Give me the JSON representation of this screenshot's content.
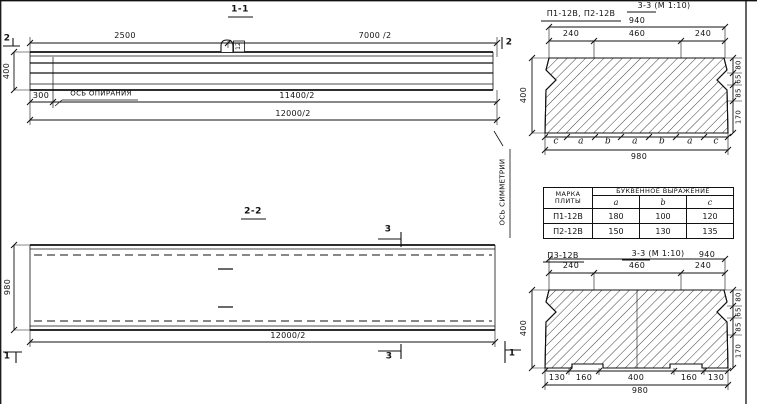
{
  "colors": {
    "ink": "#1a1a1a",
    "paper": "#ffffff"
  },
  "view_1_1": {
    "title": "1-1",
    "dim_top_left": "2500",
    "dim_top_right": "7000 /2",
    "loop_tag": "12",
    "cut_left": "2",
    "cut_right": "2",
    "dim_height": "400",
    "dim_support_offset": "300",
    "support_axis_label": "ОСЬ ОПИРАНИЯ",
    "dim_lower": "11400/2",
    "dim_total": "12000/2"
  },
  "view_2_2": {
    "title": "2-2",
    "dim_width": "980",
    "dim_total": "12000/2",
    "cut_top": "3",
    "cut_bottom": "3",
    "cut_left": "1",
    "cut_right": "1",
    "symmetry_axis_label": "ОСЬ СИММЕТРИИ"
  },
  "section_top": {
    "title": "3-3 (М 1:10)",
    "plates_label": "П1-12В, П2-12В",
    "dim_940": "940",
    "dims_top": [
      "240",
      "460",
      "240"
    ],
    "dim_height": "400",
    "dims_right": [
      "80",
      "65",
      "85",
      "170"
    ],
    "letter_row": [
      "c",
      "a",
      "b",
      "a",
      "b",
      "a",
      "c"
    ],
    "dim_total": "980"
  },
  "table": {
    "col_mark": "МАРКА ПЛИТЫ",
    "col_expr": "БУКВЕННОЕ ВЫРАЖЕНИЕ",
    "sub_cols": [
      "a",
      "b",
      "c"
    ],
    "rows": [
      {
        "mark": "П1-12В",
        "a": "180",
        "b": "100",
        "c": "120"
      },
      {
        "mark": "П2-12В",
        "a": "150",
        "b": "130",
        "c": "135"
      }
    ]
  },
  "section_bottom": {
    "plate_label": "П3-12В",
    "title": "3-3 (М 1:10)",
    "dim_940": "940",
    "dims_top": [
      "240",
      "460",
      "240"
    ],
    "dim_height": "400",
    "dims_right": [
      "80",
      "65",
      "85",
      "170"
    ],
    "dims_bottom": [
      "130",
      "160",
      "400",
      "160",
      "130"
    ],
    "dim_total": "980"
  }
}
